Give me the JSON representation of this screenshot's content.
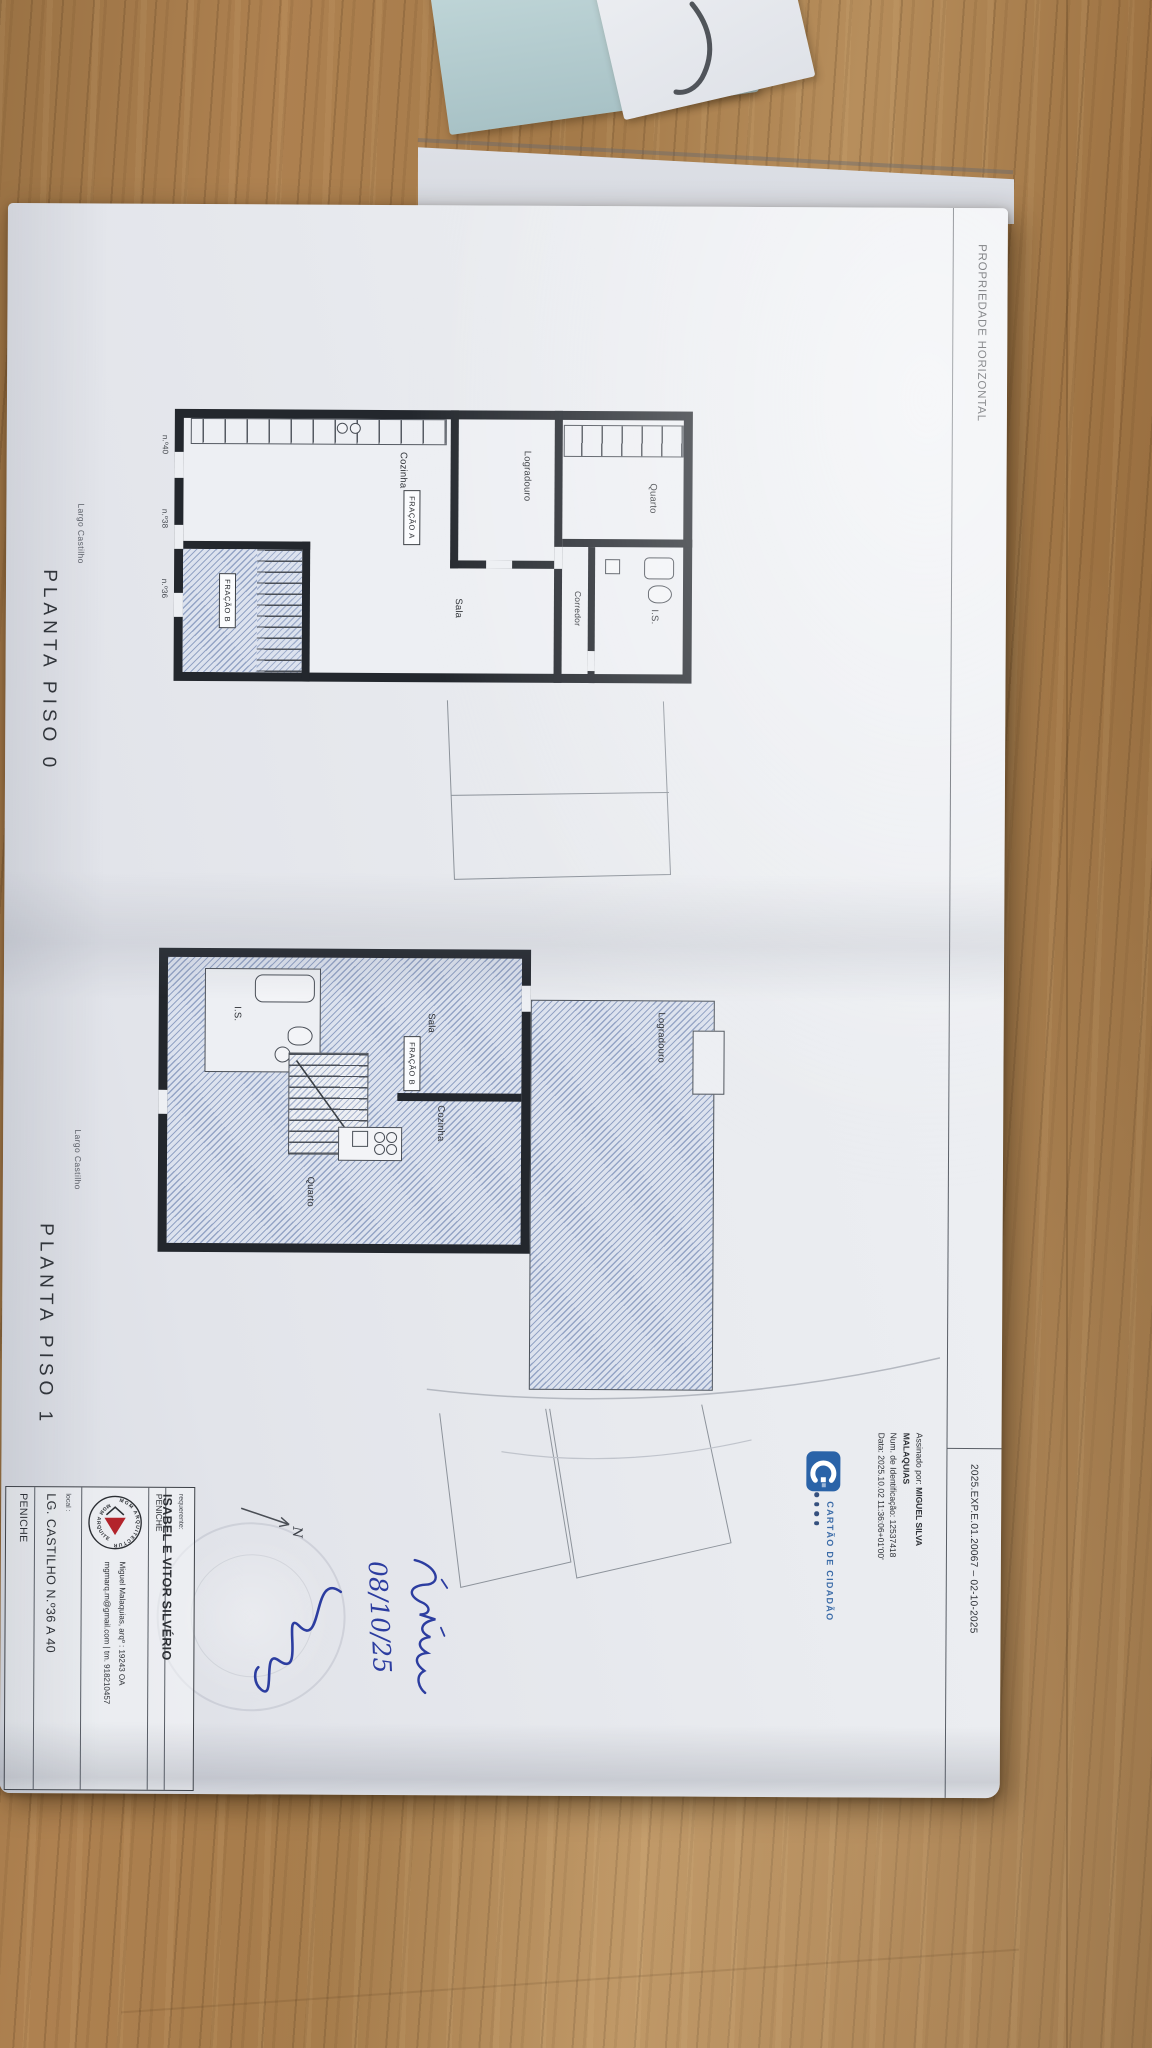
{
  "header": {
    "title": "PROPRIEDADE HORIZONTAL",
    "reference": "2025.EXP.E.01.20067 – 02-10-2025"
  },
  "plans": {
    "piso0": {
      "caption": "PLANTA PISO 0",
      "street": "Largo Castilho",
      "rooms": {
        "quarto": "Quarto",
        "is": "I.S.",
        "corredor": "Corredor",
        "logradouro": "Logradouro",
        "sala": "Sala",
        "cozinha": "Cozinha",
        "fracao_a": "FRAÇÃO A",
        "fracao_b": "FRAÇÃO B"
      },
      "doors": [
        "n.º40",
        "n.º38",
        "n.º36"
      ]
    },
    "piso1": {
      "caption": "PLANTA PISO 1",
      "street": "Largo Castilho",
      "rooms": {
        "logradouro": "Logradouro",
        "sala": "Sala",
        "cozinha": "Cozinha",
        "quarto": "Quarto",
        "is": "I.S.",
        "fracao_b": "FRAÇÃO B"
      }
    }
  },
  "signature": {
    "assinado_label": "Assinado por:",
    "name_line1": "MIGUEL SILVA",
    "name_line2": "MALAQUIAS",
    "id_line": "Num. de Identificação: 12537418",
    "date_line": "Data: 2025.10.02 11:36:06+01'00'"
  },
  "citizen_card": {
    "label": "CARTÃO DE CIDADÃO"
  },
  "title_block": {
    "requester_label": "requerente:",
    "requester": "ISABEL E VITOR SILVÉRIO",
    "requester_city": "PENICHE",
    "logo_ring": "MGM ARQUITECTURA",
    "architect_line1": "Miguel Malaquias, arqº   :   19243 OA",
    "architect_line2": "mgmarq.m@gmail.com   |   tm. 918210457",
    "local_label": "local :",
    "local_value": "LG. CASTILHO N.º36 A 40",
    "local_city": "PENICHE"
  },
  "handwriting": {
    "date": "08/10/25"
  },
  "north": {
    "label": "N"
  },
  "colors": {
    "wall_black": "#23272d",
    "hatch_blue": "#93a7c9",
    "cc_blue": "#2a63a8",
    "ink_blue": "#2c3da0",
    "mgm_red": "#b3242b",
    "teal_paper": "#b7cdd0",
    "wood": "#a87f4e"
  }
}
